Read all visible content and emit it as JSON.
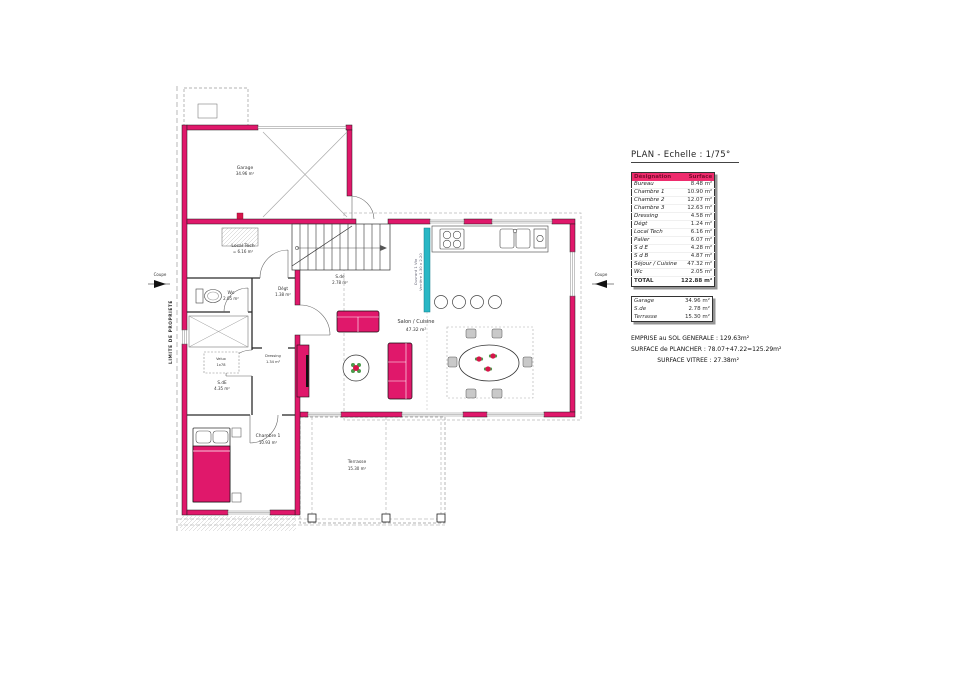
{
  "legend": {
    "title": "PLAN - Echelle : 1/75°",
    "table": {
      "col_designation": "Désignation",
      "col_surface": "Surface",
      "rows": [
        {
          "name": "Bureau",
          "area": "8.48 m²"
        },
        {
          "name": "Chambre 1",
          "area": "10.90 m²"
        },
        {
          "name": "Chambre 2",
          "area": "12.07 m²"
        },
        {
          "name": "Chambre 3",
          "area": "12.63 m²"
        },
        {
          "name": "Dressing",
          "area": "4.58 m²"
        },
        {
          "name": "Dégt",
          "area": "1.24 m²"
        },
        {
          "name": "Local Tech",
          "area": "6.16 m²"
        },
        {
          "name": "Palier",
          "area": "6.07 m²"
        },
        {
          "name": "S d E",
          "area": "4.28 m²"
        },
        {
          "name": "S d B",
          "area": "4.87 m²"
        },
        {
          "name": "Séjour / Cuisine",
          "area": "47.32 m²"
        },
        {
          "name": "Wc",
          "area": "2.05 m²"
        }
      ],
      "total_label": "TOTAL",
      "total_value": "122.88 m²"
    },
    "annex": {
      "rows": [
        {
          "name": "Garage",
          "area": "34.96 m²"
        },
        {
          "name": "S.de",
          "area": "2.78 m²"
        },
        {
          "name": "Terrasse",
          "area": "15.30 m²"
        }
      ]
    },
    "summary": {
      "line1": "EMPRISE au SOL GENERALE : 129.63m²",
      "line2": "SURFACE de PLANCHER : 78.07+47.22=125.29m²",
      "line3": "SURFACE VITREE : 27.38m²"
    }
  },
  "plan": {
    "garage_name": "Garage",
    "garage_area": "34.96 m²",
    "local_tech_name": "Local Tech",
    "local_tech_area": "= 6.16 m²",
    "wc_name": "Wc",
    "wc_area": "2.05 m²",
    "degt_name": "Dégt",
    "degt_area": "1.38 m²",
    "stair_name": "S.de",
    "stair_area": "2.78 m²",
    "velux_name": "Velux",
    "velux_size": "1x78",
    "sde_name": "S.dE",
    "sde_area": "4.35 m²",
    "dressing_name": "Dressing",
    "dressing_area": "1.34 m²",
    "salon_name": "Salon / Cuisine",
    "salon_area": "47.32 m²",
    "chambre1_name": "Chambre 1",
    "chambre1_area": "10.93 m²",
    "terrasse_name": "Terrasse",
    "terrasse_area": "15.30 m²",
    "limite_label": "LIMITE DE PROPRIETE",
    "coupe_left": "Coupe",
    "coupe_right": "Coupe",
    "glazing_note1": "Ouvrant 1 Vtx",
    "glazing_note2": "Verrière 1.30 x 2.20"
  },
  "colors": {
    "wall": "#e0186b",
    "glazing": "#29b7c5",
    "table_header_bg": "#ee2c6d",
    "table_header_text": "#7a0c2e",
    "accent_red": "#d6154a"
  }
}
